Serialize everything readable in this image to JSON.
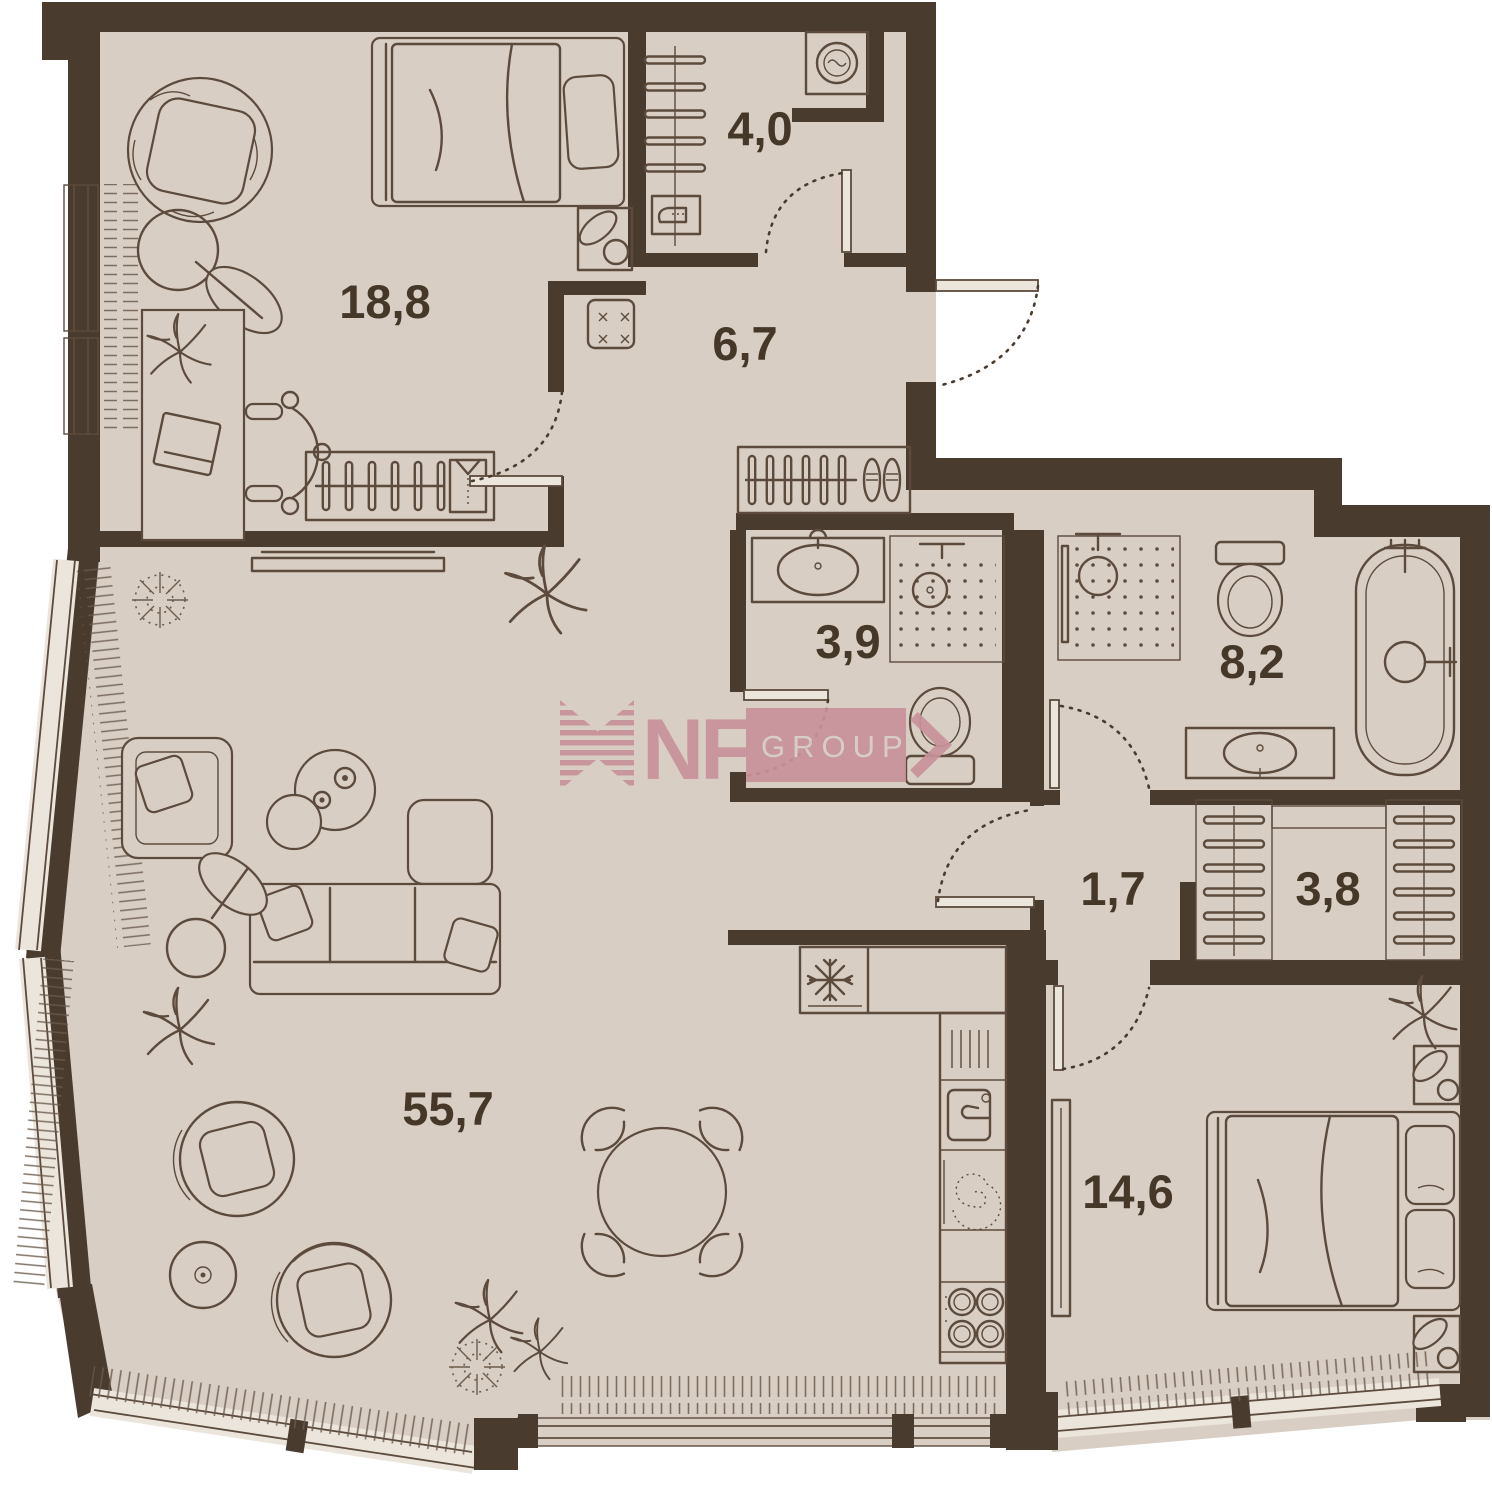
{
  "watermark": {
    "brand": "NF",
    "suffix": "GROUP",
    "color": "#c8929a"
  },
  "rooms": [
    {
      "name": "bedroom-2",
      "area": "18,8"
    },
    {
      "name": "laundry",
      "area": "4,0"
    },
    {
      "name": "hallway",
      "area": "6,7"
    },
    {
      "name": "shower-room",
      "area": "3,9"
    },
    {
      "name": "bathroom",
      "area": "8,2"
    },
    {
      "name": "vestibule",
      "area": "1,7"
    },
    {
      "name": "wardrobe",
      "area": "3,8"
    },
    {
      "name": "living-kitchen",
      "area": "55,7"
    },
    {
      "name": "master-bedroom",
      "area": "14,6"
    }
  ],
  "colors": {
    "wall": "#4a3b2f",
    "floor": "#d8cec4",
    "outside": "#ffffff",
    "furniture_line": "#5c4b3d"
  }
}
